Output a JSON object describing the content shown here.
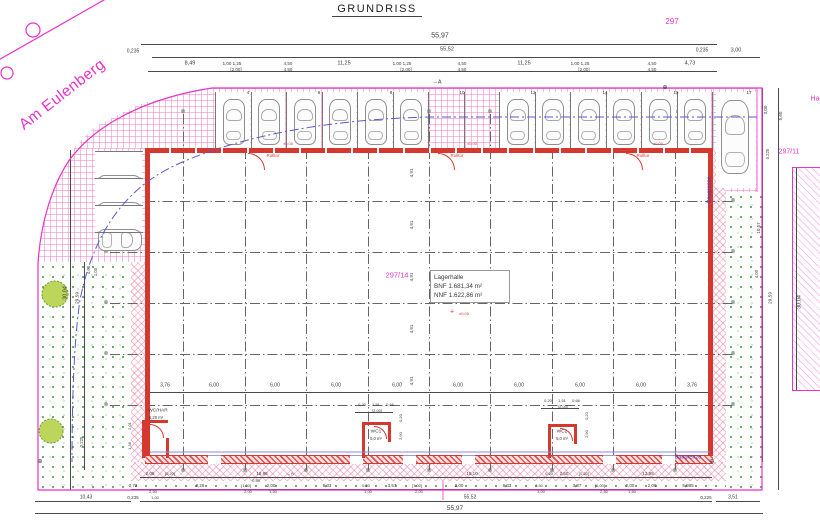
{
  "title": "GRUNDRISS",
  "street": "Am Eulenberg",
  "parcels": {
    "top": "297",
    "right": "297/11",
    "main": "297/14",
    "clipped": "Ha"
  },
  "hall": {
    "name": "Lagerhalle",
    "bnf": "BNF 1.681,34 m²",
    "nnf": "NNF 1.622,86 m²"
  },
  "boundary_label": "Baugrenze",
  "colors": {
    "magenta": "#e832c8",
    "red": "#d5382e",
    "blue": "#3c3cc8",
    "dim": "#3a3a3a",
    "green": "#3f8a3f"
  },
  "overall_dims": {
    "width_total": "55,97",
    "width_inner": "55,52",
    "depth_left": "30,04",
    "depth_right": "30,04"
  },
  "parking": {
    "top_bays": 14,
    "bay_start_x": 215,
    "bay_width": 35.5,
    "empty_bays": [
      6,
      7
    ],
    "numbers": [
      {
        "t": "4",
        "x": 248
      },
      {
        "t": "6",
        "x": 319
      },
      {
        "t": "8",
        "x": 391
      },
      {
        "t": "10",
        "x": 462
      },
      {
        "t": "12",
        "x": 533
      },
      {
        "t": "14",
        "x": 605
      },
      {
        "t": "15",
        "x": 676
      },
      {
        "t": "17",
        "x": 749
      }
    ],
    "left_bays": 3
  },
  "grid": {
    "verticals_x": [
      183,
      245,
      306,
      368,
      429,
      490,
      552,
      613,
      675
    ],
    "horizontals_y": [
      201,
      252,
      303,
      354,
      405
    ],
    "marker_symbol": "⊗",
    "top_marker_y": 112,
    "bottom_marker_y": 471,
    "left_marker_x": 106,
    "right_marker_x": 733
  },
  "dim_lines": [
    [
      141,
      44,
      576,
      1
    ],
    [
      152,
      57,
      608,
      1
    ],
    [
      148,
      71,
      569,
      1
    ],
    [
      149,
      392,
      560,
      1
    ],
    [
      140,
      477,
      572,
      1
    ],
    [
      131,
      489,
      581,
      1
    ],
    [
      35,
      501,
      96,
      1
    ],
    [
      140,
      501,
      572,
      1
    ],
    [
      716,
      501,
      44,
      1
    ],
    [
      35,
      513,
      728,
      1
    ],
    [
      70,
      150,
      1,
      340
    ],
    [
      84,
      262,
      1,
      208
    ],
    [
      762,
      88,
      1,
      374
    ],
    [
      778,
      88,
      1,
      402
    ],
    [
      796,
      168,
      1,
      222
    ],
    [
      355,
      412,
      38,
      1
    ],
    [
      541,
      408,
      38,
      1
    ]
  ],
  "door_gaps": [
    208,
    350,
    403,
    462,
    603,
    662
  ],
  "annotations": [
    {
      "t": "55,97",
      "x": 440,
      "y": 36,
      "s": 7
    },
    {
      "t": "55,52",
      "x": 447,
      "y": 50,
      "s": 5.5
    },
    {
      "t": "0,235",
      "x": 133,
      "y": 52,
      "s": 5
    },
    {
      "t": "0,235",
      "x": 702,
      "y": 51,
      "s": 5
    },
    {
      "t": "3,00",
      "x": 736,
      "y": 51,
      "s": 5.5
    },
    {
      "t": "8,49",
      "x": 190,
      "y": 64,
      "s": 5.5
    },
    {
      "t": "1,00 1,25",
      "x": 232,
      "y": 64,
      "s": 4.5
    },
    {
      "t": "[2,00]",
      "x": 236,
      "y": 70,
      "s": 4.5
    },
    {
      "t": "4,50",
      "x": 288,
      "y": 64,
      "s": 4.5
    },
    {
      "t": "4,50",
      "x": 288,
      "y": 70,
      "s": 4.5
    },
    {
      "t": "11,25",
      "x": 344,
      "y": 64,
      "s": 5.5
    },
    {
      "t": "1,00 1,25",
      "x": 402,
      "y": 64,
      "s": 4.5
    },
    {
      "t": "[2,00]",
      "x": 406,
      "y": 70,
      "s": 4.5
    },
    {
      "t": "4,50",
      "x": 462,
      "y": 64,
      "s": 4.5
    },
    {
      "t": "4,50",
      "x": 462,
      "y": 70,
      "s": 4.5
    },
    {
      "t": "11,25",
      "x": 524,
      "y": 64,
      "s": 5.5
    },
    {
      "t": "1,00 1,25",
      "x": 580,
      "y": 64,
      "s": 4.5
    },
    {
      "t": "[2,00]",
      "x": 584,
      "y": 70,
      "s": 4.5
    },
    {
      "t": "4,50",
      "x": 652,
      "y": 64,
      "s": 4.5
    },
    {
      "t": "4,50",
      "x": 652,
      "y": 70,
      "s": 4.5
    },
    {
      "t": "4,73",
      "x": 690,
      "y": 64,
      "s": 5.5
    },
    {
      "t": "→A",
      "x": 437,
      "y": 83,
      "s": 5.5
    },
    {
      "t": "Rolltor",
      "x": 273,
      "y": 156,
      "c": "r",
      "s": 4.5
    },
    {
      "t": "Rolltor",
      "x": 457,
      "y": 156,
      "c": "r",
      "s": 4.5
    },
    {
      "t": "Rolltor",
      "x": 643,
      "y": 156,
      "c": "r",
      "s": 4.5
    },
    {
      "t": "±0,00",
      "x": 288,
      "y": 144,
      "c": "r",
      "s": 4
    },
    {
      "t": "±0,00",
      "x": 472,
      "y": 144,
      "c": "r",
      "s": 4
    },
    {
      "t": "±0,00",
      "x": 658,
      "y": 144,
      "c": "r",
      "s": 4
    },
    {
      "t": "4,91",
      "x": 412,
      "y": 173,
      "r": 1,
      "s": 4.5
    },
    {
      "t": "4,91",
      "x": 412,
      "y": 225,
      "r": 1,
      "s": 4.5
    },
    {
      "t": "4,91",
      "x": 412,
      "y": 277,
      "r": 1,
      "s": 4.5
    },
    {
      "t": "4,91",
      "x": 412,
      "y": 329,
      "r": 1,
      "s": 4.5
    },
    {
      "t": "4,91",
      "x": 412,
      "y": 381,
      "r": 1,
      "s": 4.5
    },
    {
      "t": "+",
      "x": 452,
      "y": 312,
      "c": "r",
      "s": 7
    },
    {
      "t": "±0,00",
      "x": 464,
      "y": 314,
      "c": "r",
      "s": 4
    },
    {
      "t": "3,76",
      "x": 165,
      "y": 386,
      "s": 5
    },
    {
      "t": "6,00",
      "x": 214,
      "y": 386,
      "s": 5
    },
    {
      "t": "6,00",
      "x": 275,
      "y": 386,
      "s": 5
    },
    {
      "t": "6,00",
      "x": 336,
      "y": 386,
      "s": 5
    },
    {
      "t": "6,00",
      "x": 397,
      "y": 386,
      "s": 5
    },
    {
      "t": "6,00",
      "x": 458,
      "y": 386,
      "s": 5
    },
    {
      "t": "6,00",
      "x": 519,
      "y": 386,
      "s": 5
    },
    {
      "t": "6,00",
      "x": 580,
      "y": 386,
      "s": 5
    },
    {
      "t": "6,00",
      "x": 641,
      "y": 386,
      "s": 5
    },
    {
      "t": "3,76",
      "x": 692,
      "y": 386,
      "s": 5
    },
    {
      "t": "WC/HAR",
      "x": 158,
      "y": 412,
      "s": 4.8
    },
    {
      "t": "6,20 m²",
      "x": 156,
      "y": 418,
      "s": 4.2
    },
    {
      "t": "WC1",
      "x": 376,
      "y": 433,
      "s": 4.8
    },
    {
      "t": "5,0 m²",
      "x": 376,
      "y": 439,
      "s": 4.2
    },
    {
      "t": "WC2",
      "x": 562,
      "y": 433,
      "s": 4.8
    },
    {
      "t": "5,0 m²",
      "x": 562,
      "y": 439,
      "s": 4.2
    },
    {
      "t": "0,20",
      "x": 362,
      "y": 405,
      "s": 4
    },
    {
      "t": "1,51",
      "x": 376,
      "y": 405,
      "s": 4
    },
    {
      "t": "0,66",
      "x": 390,
      "y": 405,
      "s": 4
    },
    {
      "t": "[2,00]",
      "x": 377,
      "y": 411,
      "s": 4
    },
    {
      "t": "0,20",
      "x": 548,
      "y": 401,
      "s": 4
    },
    {
      "t": "1,51",
      "x": 562,
      "y": 401,
      "s": 4
    },
    {
      "t": "0,66",
      "x": 576,
      "y": 401,
      "s": 4
    },
    {
      "t": "[2,00]",
      "x": 563,
      "y": 407,
      "s": 4
    },
    {
      "t": "0,20",
      "x": 401,
      "y": 418,
      "r": 1,
      "s": 4
    },
    {
      "t": "2,90",
      "x": 401,
      "y": 436,
      "r": 1,
      "s": 4
    },
    {
      "t": "0,20",
      "x": 587,
      "y": 416,
      "r": 1,
      "s": 4
    },
    {
      "t": "2,90",
      "x": 587,
      "y": 434,
      "r": 1,
      "s": 4
    },
    {
      "t": "2,01",
      "x": 130,
      "y": 426,
      "r": 1,
      "s": 4
    },
    {
      "t": "1,38",
      "x": 130,
      "y": 446,
      "r": 1,
      "s": 4
    },
    {
      "t": "2,06",
      "x": 150,
      "y": 474,
      "s": 4.5
    },
    {
      "t": "[0,20]",
      "x": 170,
      "y": 474,
      "s": 4
    },
    {
      "t": "18,95",
      "x": 262,
      "y": 474,
      "s": 4.5
    },
    {
      "t": "→A",
      "x": 290,
      "y": 474,
      "s": 4.5
    },
    {
      "t": "0,50",
      "x": 256,
      "y": 481,
      "s": 4
    },
    {
      "t": "15,10",
      "x": 472,
      "y": 474,
      "s": 4.5
    },
    {
      "t": "0,20",
      "x": 549,
      "y": 474,
      "s": 4
    },
    {
      "t": "2,50",
      "x": 564,
      "y": 474,
      "s": 4.5
    },
    {
      "t": "[0,20]",
      "x": 584,
      "y": 474,
      "s": 4
    },
    {
      "t": "12,95",
      "x": 648,
      "y": 474,
      "s": 4.5
    },
    {
      "t": "0,72",
      "x": 133,
      "y": 486,
      "s": 4.5
    },
    {
      "t": "2,50",
      "x": 153,
      "y": 492,
      "s": 4
    },
    {
      "t": "1,00",
      "x": 155,
      "y": 498,
      "s": 4
    },
    {
      "t": "8,26",
      "x": 200,
      "y": 486,
      "s": 4.5
    },
    {
      "t": "[1,00]",
      "x": 246,
      "y": 486,
      "s": 4
    },
    {
      "t": "2,00",
      "x": 248,
      "y": 492,
      "s": 4
    },
    {
      "t": "2,00",
      "x": 271,
      "y": 486,
      "s": 4.5
    },
    {
      "t": "1,50",
      "x": 273,
      "y": 492,
      "s": 4
    },
    {
      "t": "8,33",
      "x": 327,
      "y": 486,
      "s": 4.5
    },
    {
      "t": "0,50",
      "x": 366,
      "y": 486,
      "s": 4
    },
    {
      "t": "1,00",
      "x": 368,
      "y": 492,
      "s": 4
    },
    {
      "t": "3,57",
      "x": 392,
      "y": 486,
      "s": 4.5
    },
    {
      "t": "[1,00]",
      "x": 417,
      "y": 486,
      "s": 4
    },
    {
      "t": "2,00",
      "x": 419,
      "y": 492,
      "s": 4
    },
    {
      "t": "2,00",
      "x": 459,
      "y": 486,
      "s": 4.5
    },
    {
      "t": "8,33",
      "x": 507,
      "y": 486,
      "s": 4.5
    },
    {
      "t": "0,50",
      "x": 539,
      "y": 486,
      "s": 4
    },
    {
      "t": "1,00",
      "x": 541,
      "y": 492,
      "s": 4
    },
    {
      "t": "3,87",
      "x": 577,
      "y": 486,
      "s": 4.5
    },
    {
      "t": "[1,00]",
      "x": 600,
      "y": 486,
      "s": 4
    },
    {
      "t": "2,50",
      "x": 604,
      "y": 492,
      "s": 4
    },
    {
      "t": "2,00",
      "x": 630,
      "y": 486,
      "s": 4.5
    },
    {
      "t": "1,50",
      "x": 632,
      "y": 492,
      "s": 4
    },
    {
      "t": "2,00",
      "x": 652,
      "y": 486,
      "s": 4.5
    },
    {
      "t": "5,985",
      "x": 688,
      "y": 486,
      "s": 4.5
    },
    {
      "t": "10,43",
      "x": 86,
      "y": 498,
      "s": 5
    },
    {
      "t": "0,235",
      "x": 133,
      "y": 498,
      "s": 4.5
    },
    {
      "t": "55,52",
      "x": 470,
      "y": 498,
      "s": 5
    },
    {
      "t": "0,225",
      "x": 706,
      "y": 498,
      "s": 4.5
    },
    {
      "t": "3,51",
      "x": 733,
      "y": 498,
      "s": 5
    },
    {
      "t": "55,97",
      "x": 455,
      "y": 509,
      "s": 6.5
    },
    {
      "t": "30,04",
      "x": 66,
      "y": 293,
      "r": 1,
      "s": 5.5
    },
    {
      "t": "29,59",
      "x": 79,
      "y": 298,
      "r": 1,
      "s": 4.8
    },
    {
      "t": "4,00",
      "x": 89,
      "y": 270,
      "r": 1,
      "s": 4.2
    },
    {
      "t": "1,00",
      "x": 96,
      "y": 272,
      "r": 1,
      "s": 4.2
    },
    {
      "t": "0,225",
      "x": 82,
      "y": 442,
      "r": 1,
      "s": 4.2
    },
    {
      "t": "3,00",
      "x": 766,
      "y": 110,
      "r": 1,
      "s": 4.5
    },
    {
      "t": "5,60",
      "x": 781,
      "y": 116,
      "r": 1,
      "s": 4.5
    },
    {
      "t": "0,225",
      "x": 768,
      "y": 154,
      "r": 1,
      "s": 4.2
    },
    {
      "t": "10,57",
      "x": 759,
      "y": 228,
      "r": 1,
      "s": 4.5
    },
    {
      "t": "4,00",
      "x": 757,
      "y": 274,
      "r": 1,
      "s": 4.2
    },
    {
      "t": "29,59",
      "x": 772,
      "y": 298,
      "r": 1,
      "s": 4.8
    },
    {
      "t": "30,04",
      "x": 800,
      "y": 302,
      "r": 1,
      "s": 5.5
    },
    {
      "t": "⊕",
      "x": 40,
      "y": 462,
      "s": 6
    },
    {
      "t": "⊕",
      "x": 665,
      "y": 88,
      "s": 6
    },
    {
      "t": "⊕",
      "x": 712,
      "y": 462,
      "s": 6
    }
  ]
}
